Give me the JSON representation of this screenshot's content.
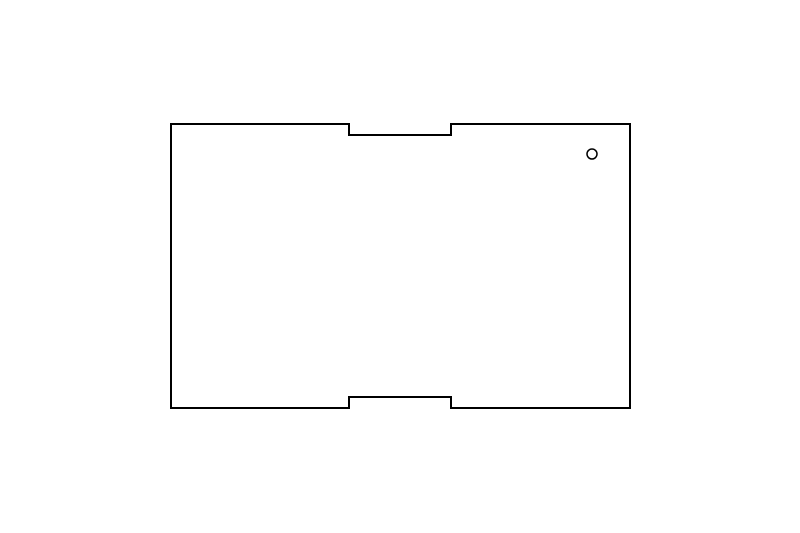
{
  "canvas": {
    "width": 800,
    "height": 533,
    "background_color": "#ffffff"
  },
  "drawing": {
    "shape_name": "rectangular-panel-outline-with-edge-notches-and-hole",
    "stroke_color": "#000000",
    "fill_color": "#ffffff",
    "outline_stroke_width": 2,
    "hole_stroke_width": 1.5,
    "panel": {
      "left": 171,
      "top": 124,
      "right": 630,
      "bottom": 408
    },
    "top_notch": {
      "left": 349,
      "right": 451,
      "depth": 11
    },
    "bottom_notch": {
      "left": 349,
      "right": 451,
      "depth": 11
    },
    "hole": {
      "cx": 592,
      "cy": 154,
      "r": 5
    }
  }
}
